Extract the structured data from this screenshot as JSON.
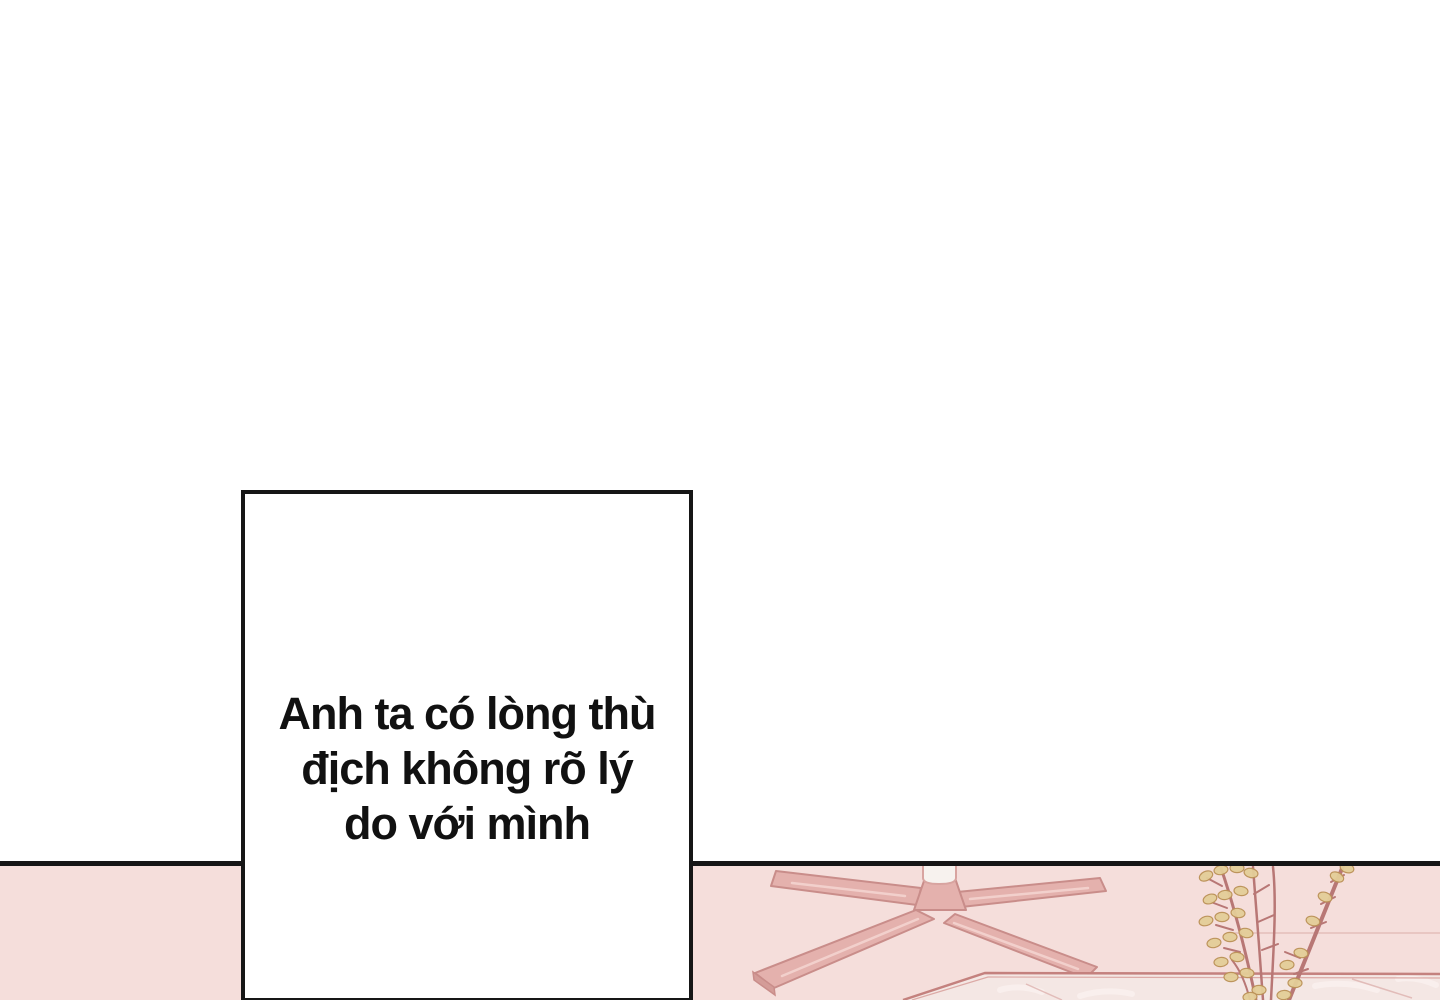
{
  "panel": {
    "dialogue": {
      "line1": "Anh ta có lòng thù",
      "line2": "địch không rõ lý",
      "line3": "do với mình"
    },
    "colors": {
      "page_bg": "#ffffff",
      "line_black": "#161616",
      "floor_pink": "#f5dedb",
      "chair_fill": "#e4b1ad",
      "chair_outline": "#c98d8a",
      "chair_column": "#f7f2ee",
      "table_edge": "#c4817e",
      "marble_fill": "#f4e7e4",
      "plant_stem": "#b87775",
      "plant_leaf": "#e4ce98",
      "plant_leaf_outline": "#bb9156",
      "text_color": "#111111"
    }
  }
}
